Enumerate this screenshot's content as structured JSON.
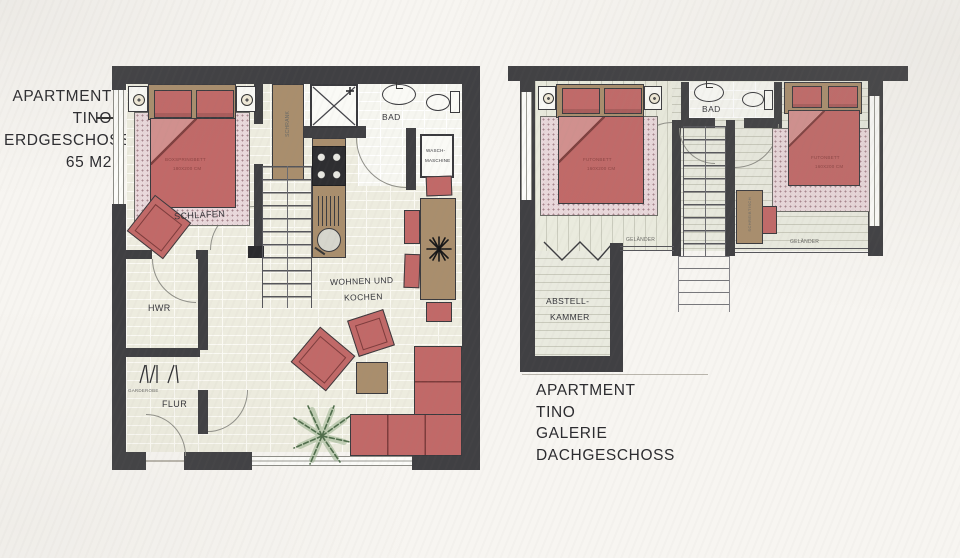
{
  "colors": {
    "wall": "#404043",
    "furniture_red": "#c16968",
    "wood": "#a98e6d",
    "carpet_pink": "#e9d8db",
    "paper": "#f7f5f1",
    "plant_green": "#5e7c58"
  },
  "floorplan_left": {
    "title_lines": [
      "APARTMENT",
      "TINO",
      "ERDGESCHOSS",
      "65 M2"
    ],
    "labels": {
      "schlafen": "SCHLAFEN",
      "bad": "BAD",
      "hwr": "HWR",
      "flur": "FLUR",
      "garderobe": "GARDEROBE",
      "wohnen_line1": "WOHNEN UND",
      "wohnen_line2": "KOCHEN",
      "schrank": "SCHRANK",
      "bed_line1": "BOXSPRINGBETT",
      "bed_line2": "180X200 CM",
      "wasch_line1": "WASCH-",
      "wasch_line2": "MASCHINE"
    }
  },
  "floorplan_right": {
    "title_lines": [
      "APARTMENT",
      "TINO",
      "GALERIE",
      "DACHGESCHOSS"
    ],
    "labels": {
      "bad": "BAD",
      "abstell_line1": "ABSTELL-",
      "abstell_line2": "KAMMER",
      "gelaender_left": "GELÄNDER",
      "gelaender_right": "GELÄNDER",
      "bed1_line1": "FUTONBETT",
      "bed1_line2": "160X200 CM",
      "bed2_line1": "FUTONBETT",
      "bed2_line2": "160X200 CM",
      "desk": "SCHREIBTISCH"
    }
  }
}
